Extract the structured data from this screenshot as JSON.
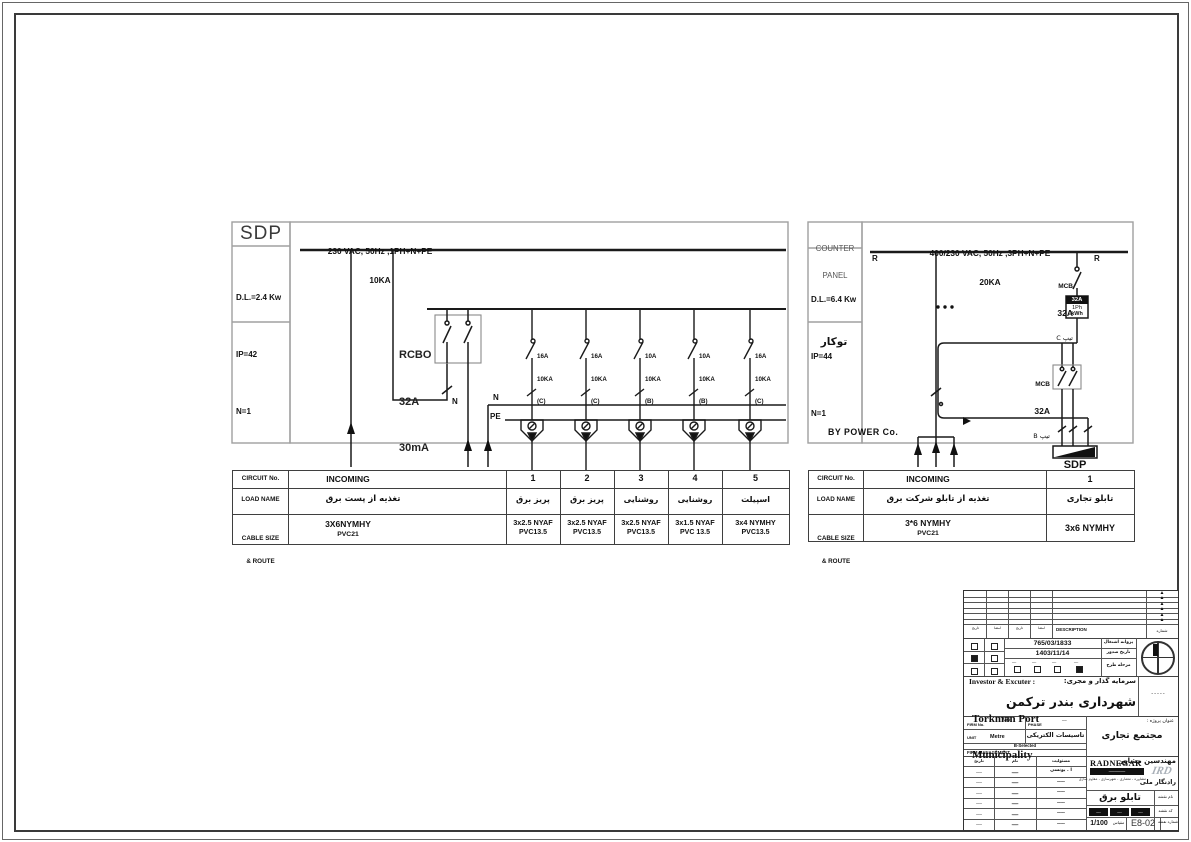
{
  "sdp_panel": {
    "title": "SDP",
    "specs": [
      "D.L.=2.4 Kw",
      "IP=42",
      "N=1"
    ],
    "bus_voltage": "230 VAC, 50Hz ,1PH+N+PE",
    "bus_ka": "10KA",
    "rcbo": [
      "RCBO",
      "32A",
      "30mA"
    ],
    "n1": "N",
    "n2": "N",
    "pe": "PE",
    "breakers": [
      {
        "amp": "16A",
        "ka": "10KA",
        "curve": "(C)"
      },
      {
        "amp": "16A",
        "ka": "10KA",
        "curve": "(C)"
      },
      {
        "amp": "10A",
        "ka": "10KA",
        "curve": "(B)"
      },
      {
        "amp": "10A",
        "ka": "10KA",
        "curve": "(B)"
      },
      {
        "amp": "16A",
        "ka": "10KA",
        "curve": "(C)"
      }
    ],
    "table": {
      "h_circuit": "CIRCUIT No.",
      "h_load": "LOAD NAME",
      "h_cable1": "CABLE SIZE",
      "h_cable2": "& ROUTE",
      "incoming": {
        "no": "INCOMING",
        "load": "تغذیه از پست برق",
        "cable": "3X6NYMHY",
        "route": "PVC21"
      },
      "circuits": [
        {
          "no": "1",
          "load": "پریز برق",
          "cable": "3x2.5 NYAF",
          "route": "PVC13.5"
        },
        {
          "no": "2",
          "load": "پریز برق",
          "cable": "3x2.5 NYAF",
          "route": "PVC13.5"
        },
        {
          "no": "3",
          "load": "روشنایی",
          "cable": "3x2.5 NYAF",
          "route": "PVC13.5"
        },
        {
          "no": "4",
          "load": "روشنایی",
          "cable": "3x1.5 NYAF",
          "route": "PVC 13.5"
        },
        {
          "no": "5",
          "load": "اسپیلت",
          "cable": "3x4 NYMHY",
          "route": "PVC13.5"
        }
      ]
    }
  },
  "counter_panel": {
    "title1": "COUNTER",
    "title2": "PANEL",
    "specs": [
      "D.L.=6.4 Kw",
      "IP=44",
      "N=1"
    ],
    "mount": "توکار",
    "bus_voltage": "400/230 VAC, 50Hz ,3PH+N+PE",
    "bus_ka": "20KA",
    "r_left": "R",
    "r_right": "R",
    "mcb_top": {
      "name": "MCB",
      "amp": "32A",
      "tip": "تیپ C"
    },
    "meter": {
      "amp": "32A",
      "ph": "1Ph",
      "kwh": "kWh"
    },
    "mcb_bottom": {
      "name": "MCB",
      "amp": "32A",
      "tip": "تیپ B"
    },
    "by_power": "BY POWER Co.",
    "sdp_out": "SDP",
    "table": {
      "h_circuit": "CIRCUIT No.",
      "h_load": "LOAD NAME",
      "h_cable1": "CABLE SIZE",
      "h_cable2": "& ROUTE",
      "incoming": {
        "no": "INCOMING",
        "load": "تغذیه از تابلو شرکت برق",
        "cable": "3*6 NYMHY",
        "route": "PVC21"
      },
      "circuits": [
        {
          "no": "1",
          "load": "تابلو تجاری",
          "cable": "3x6 NYMHY",
          "route": ""
        }
      ]
    }
  },
  "title_block": {
    "revision": {
      "description": "DESCRIPTION",
      "no_label": "شماره",
      "col_labels": [
        "تاریخ",
        "امضا",
        "تاریخ",
        "امضا"
      ]
    },
    "approval": {
      "license_no": "765/03/1833",
      "license_label": "پروانه اشتغال",
      "date": "1403/11/14",
      "date_label": "تاریخ صدور",
      "stage_label": "مرحله طرح",
      "stage_options": [
        "ــــ",
        "ــــ",
        "ــــ",
        "ــــ"
      ]
    },
    "investor": {
      "en_label": "Investor & Excuter :",
      "fa_label": "سرمایه گذار و مجری:",
      "en1": "Torkman Port",
      "en2": "Municipality",
      "fa": "شهرداری بندر ترکمن",
      "stamp": "ـ ـ ـ ـ ـ"
    },
    "project": {
      "fa_label": "عنوان پروژه :",
      "fa": "مجتمع تجاری",
      "firm_no_label": "FIRM No.",
      "firm_no": "765",
      "phase_label": "PHASE",
      "phase": "ــــ",
      "unit_label": "UNIT",
      "unit": "Metre",
      "discipline": "تاسیسات الکتریکی",
      "selected": "B-Selected",
      "mgmt": "FIRM MANAGEMENT"
    },
    "signs": {
      "headers": [
        "تاریخ",
        "نام",
        "مسئولیت"
      ],
      "rows": [
        {
          "c1": "ـــــ",
          "c2": "ـــــ",
          "c3": "ا . یونسی"
        },
        {
          "c1": "ـــــ",
          "c2": "ـــــ",
          "c3": "ـــــ"
        },
        {
          "c1": "ـــــ",
          "c2": "ـــــ",
          "c3": "ـــــ"
        },
        {
          "c1": "ـــــ",
          "c2": "ـــــ",
          "c3": "ـــــ"
        },
        {
          "c1": "ـــــ",
          "c2": "ـــــ",
          "c3": "ـــــ"
        },
        {
          "c1": "ـــــ",
          "c2": "ـــــ",
          "c3": "ـــــ"
        }
      ]
    },
    "consultant": {
      "logo_en": "RADNEGAR",
      "bar_text": "ــــــــــــــــ",
      "fa_title": "مهندسین مشاور",
      "fa_name": "رادنگار ملی",
      "services": "مشاوره ، معماری ، شهرسازی ، مقاوم سازی",
      "logo_mark": "IRD"
    },
    "drawing": {
      "name_label": "نام نقشه",
      "name": "تابلو برق",
      "code_label": "کد نقشه",
      "code_segs": [
        "ـــــ",
        "ـــــ",
        "ـــــ"
      ],
      "scale_label": "مقیاس",
      "scale": "1/100",
      "sheet_label": "شماره نقشه",
      "sheet": "E8-02"
    }
  }
}
